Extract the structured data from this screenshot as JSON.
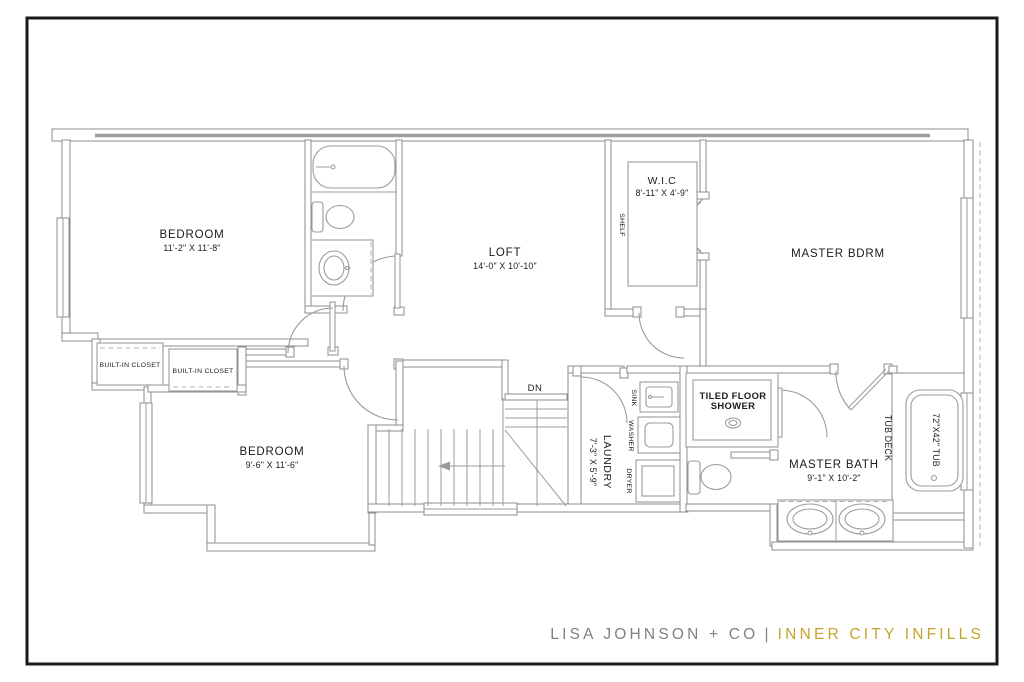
{
  "drawing_type": "second-floor residential floor plan",
  "rooms": {
    "bedroom1": {
      "name": "BEDROOM",
      "dims": "11'-2\" X 11'-8\""
    },
    "bedroom2": {
      "name": "BEDROOM",
      "dims": "9'-6\" X 11'-6\""
    },
    "loft": {
      "name": "LOFT",
      "dims": "14'-0\" X 10'-10\""
    },
    "wic": {
      "name": "W.I.C",
      "dims": "8'-11\" X 4'-9\""
    },
    "master_bedroom": {
      "name": "MASTER BDRM"
    },
    "master_bath": {
      "name": "MASTER BATH",
      "dims": "9'-1\" X 10'-2\""
    },
    "laundry": {
      "name": "LAUNDRY",
      "dims": "7'-3\" X 5'-9\""
    }
  },
  "labels": {
    "shower_line1": "TILED FLOOR",
    "shower_line2": "SHOWER",
    "tub": "72\"X42\" TUB",
    "tub_deck": "TUB DECK",
    "shelf": "SHELF",
    "sink": "SINK",
    "washer": "WASHER",
    "dryer": "DRYER",
    "closet1": "BUILT-IN CLOSET",
    "closet2": "BUILT-IN CLOSET",
    "stairs_down": "DN"
  },
  "branding": {
    "company": "LISA JOHNSON + CO",
    "separator": "|",
    "project": "INNER CITY INFILLS",
    "company_color": "#808184",
    "project_color": "#c5a42c"
  },
  "colors": {
    "background": "#ffffff",
    "frame": "#1a1a1a",
    "wall": "#8d8d8d",
    "fixture": "#9b9b9b",
    "text": "#1b1b1b"
  }
}
